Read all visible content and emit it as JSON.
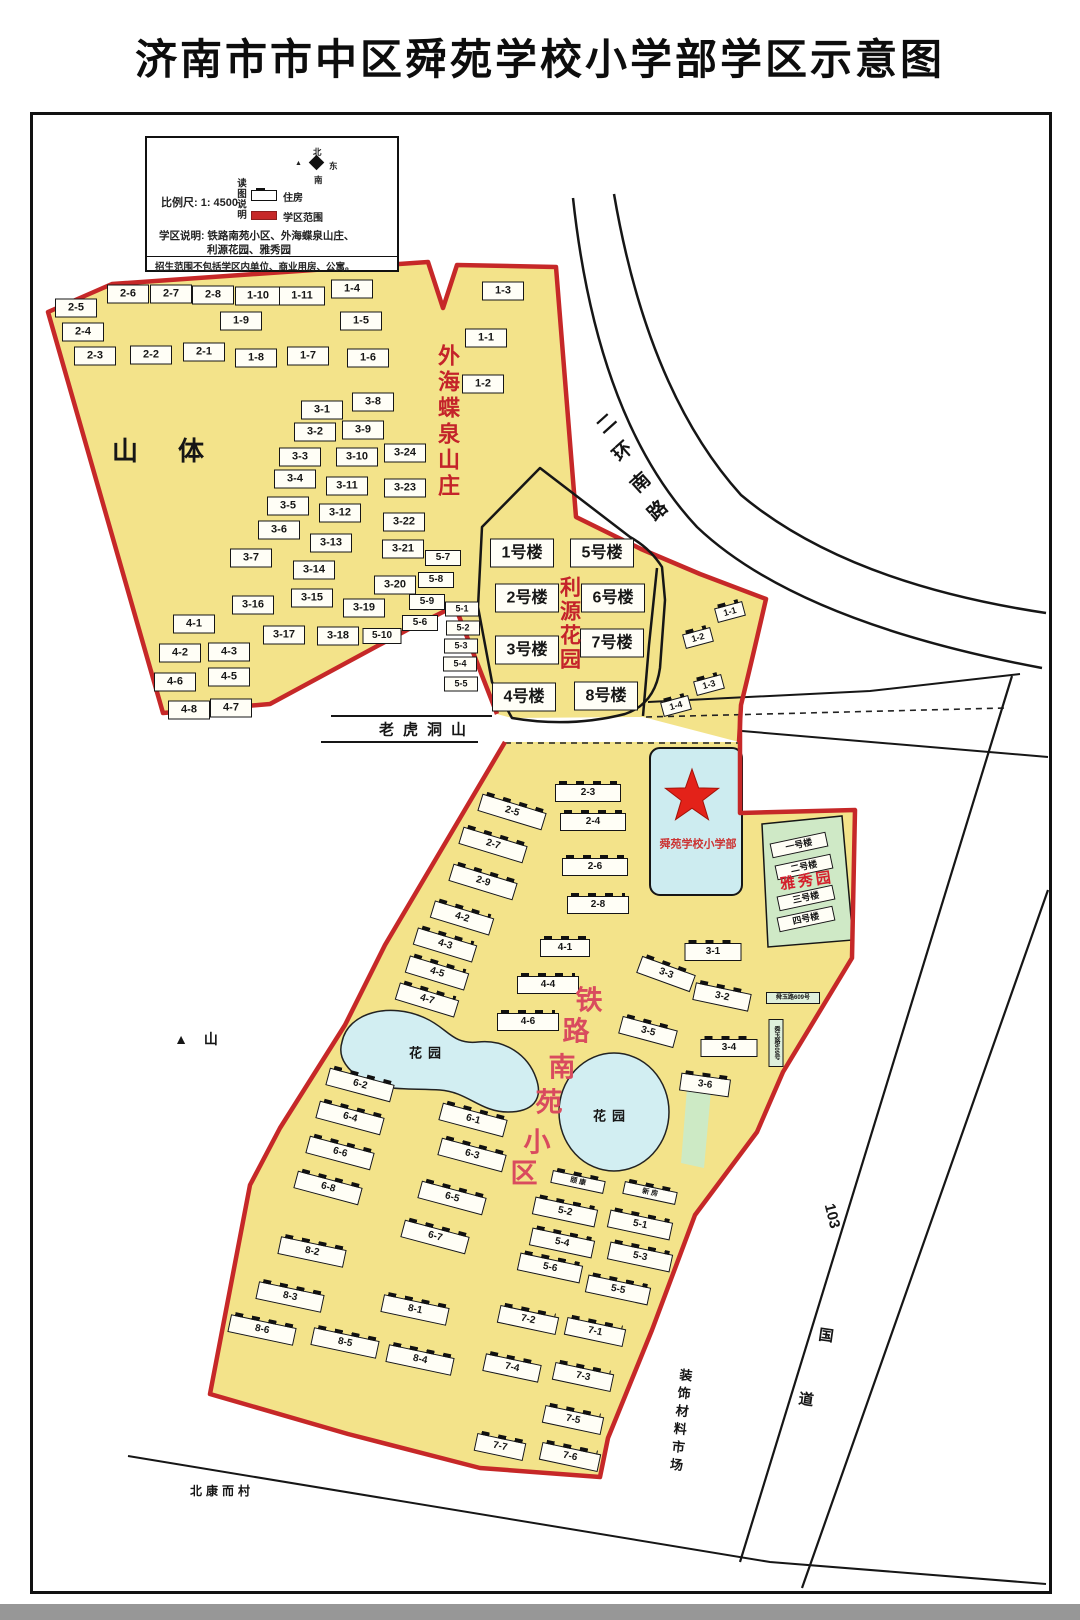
{
  "title": "济南市市中区舜苑学校小学部学区示意图",
  "legend": {
    "scale_label": "比例尺: 1: 4500",
    "reading_note": "读图说明",
    "housing_label": "住房",
    "district_range_label": "学区范围",
    "compass": {
      "north": "北",
      "east": "东",
      "south": "南"
    },
    "district_desc_line1": "学区说明: 铁路南苑小区、外海蝶泉山庄、",
    "district_desc_line2": "利源花园、雅秀园",
    "note": "招生范围不包括学区内单位、商业用房、公寓。"
  },
  "colors": {
    "district_yellow": "#f3e38a",
    "boundary_red": "#c62828",
    "liyuan_outline_black": "#161616",
    "school_cyan": "#cdecf0",
    "pond_cyan": "#d2eef2",
    "green_area": "#cfe9c6",
    "star_red": "#e32219",
    "red_text": "#c4232a",
    "pink_text": "#d94b5e"
  },
  "map": {
    "labels": [
      {
        "t": "山体",
        "x": 178,
        "y": 451,
        "f": 26,
        "ls": 40
      },
      {
        "t": "▲  山",
        "x": 199,
        "y": 1039,
        "f": 14,
        "ls": 6
      },
      {
        "t": "老虎洞山",
        "x": 427,
        "y": 730,
        "f": 15,
        "ls": 9
      },
      {
        "t": "花园",
        "x": 428,
        "y": 1053,
        "f": 13,
        "ls": 6
      },
      {
        "t": "花园",
        "x": 612,
        "y": 1116,
        "f": 13,
        "ls": 6
      },
      {
        "t": "外海蝶泉山庄",
        "x": 447,
        "y": 422,
        "f": 22,
        "c": "#c4232a",
        "vert": true,
        "ls": 4
      },
      {
        "t": "利源花园",
        "x": 569,
        "y": 624,
        "f": 21,
        "c": "#c4232a",
        "vert": true,
        "ls": 3
      },
      {
        "t": "雅秀园",
        "x": 807,
        "y": 881,
        "f": 15,
        "c": "#d41f2c",
        "r": -8,
        "ls": 3
      },
      {
        "t": "舜苑学校小学部",
        "x": 698,
        "y": 845,
        "f": 11,
        "c": "#cc3333"
      },
      {
        "t": "装饰材料市场",
        "x": 680,
        "y": 1422,
        "f": 13,
        "vert": true,
        "ls": 5,
        "r": 6
      },
      {
        "t": "103",
        "x": 832,
        "y": 1216,
        "f": 15,
        "r": 76
      },
      {
        "t": "国",
        "x": 826,
        "y": 1336,
        "f": 15,
        "r": 8
      },
      {
        "t": "道",
        "x": 806,
        "y": 1400,
        "f": 15,
        "r": 8
      },
      {
        "t": "北康而村",
        "x": 222,
        "y": 1491,
        "f": 12,
        "ls": 4
      }
    ],
    "char_labels": [
      {
        "id": "tielu-nanyuan-xiaoqu",
        "c": "#d94b5e",
        "f": 27,
        "r": 0,
        "chars": [
          {
            "t": "铁",
            "x": 589,
            "y": 1001
          },
          {
            "t": "路",
            "x": 576,
            "y": 1032
          },
          {
            "t": "南",
            "x": 562,
            "y": 1068
          },
          {
            "t": "苑",
            "x": 549,
            "y": 1103
          },
          {
            "t": "小",
            "x": 537,
            "y": 1143
          },
          {
            "t": "区",
            "x": 524,
            "y": 1174
          }
        ]
      },
      {
        "id": "erhuan-nanlu",
        "c": "#141414",
        "f": 19,
        "r": -42,
        "chars": [
          {
            "t": "二",
            "x": 607,
            "y": 424
          },
          {
            "t": "环",
            "x": 623,
            "y": 452
          },
          {
            "t": "南",
            "x": 641,
            "y": 483
          },
          {
            "t": "路",
            "x": 658,
            "y": 511
          }
        ]
      }
    ],
    "buildings_plain": [
      {
        "t": "2-6",
        "x": 128,
        "y": 294
      },
      {
        "t": "2-7",
        "x": 171,
        "y": 294
      },
      {
        "t": "2-8",
        "x": 213,
        "y": 295
      },
      {
        "t": "1-10",
        "x": 258,
        "y": 296,
        "w": 44
      },
      {
        "t": "1-11",
        "x": 302,
        "y": 296,
        "w": 44
      },
      {
        "t": "1-4",
        "x": 352,
        "y": 289
      },
      {
        "t": "1-3",
        "x": 503,
        "y": 291
      },
      {
        "t": "2-5",
        "x": 76,
        "y": 308
      },
      {
        "t": "1-9",
        "x": 241,
        "y": 321
      },
      {
        "t": "1-5",
        "x": 361,
        "y": 321
      },
      {
        "t": "2-4",
        "x": 83,
        "y": 332
      },
      {
        "t": "1-6",
        "x": 368,
        "y": 358
      },
      {
        "t": "2-3",
        "x": 95,
        "y": 356
      },
      {
        "t": "2-2",
        "x": 151,
        "y": 355
      },
      {
        "t": "2-1",
        "x": 204,
        "y": 352
      },
      {
        "t": "1-8",
        "x": 256,
        "y": 358
      },
      {
        "t": "1-7",
        "x": 308,
        "y": 356
      },
      {
        "t": "1-1",
        "x": 486,
        "y": 338
      },
      {
        "t": "1-2",
        "x": 483,
        "y": 384
      },
      {
        "t": "3-1",
        "x": 322,
        "y": 410
      },
      {
        "t": "3-8",
        "x": 373,
        "y": 402
      },
      {
        "t": "3-2",
        "x": 315,
        "y": 432
      },
      {
        "t": "3-9",
        "x": 363,
        "y": 430
      },
      {
        "t": "3-3",
        "x": 300,
        "y": 457
      },
      {
        "t": "3-10",
        "x": 357,
        "y": 457
      },
      {
        "t": "3-24",
        "x": 405,
        "y": 453
      },
      {
        "t": "3-4",
        "x": 295,
        "y": 479
      },
      {
        "t": "3-11",
        "x": 347,
        "y": 486
      },
      {
        "t": "3-23",
        "x": 405,
        "y": 488
      },
      {
        "t": "3-5",
        "x": 288,
        "y": 506
      },
      {
        "t": "3-12",
        "x": 340,
        "y": 513
      },
      {
        "t": "3-22",
        "x": 404,
        "y": 522
      },
      {
        "t": "3-6",
        "x": 279,
        "y": 530
      },
      {
        "t": "3-13",
        "x": 331,
        "y": 543
      },
      {
        "t": "3-21",
        "x": 403,
        "y": 549
      },
      {
        "t": "5-7",
        "x": 443,
        "y": 558,
        "w": 34,
        "h": 14,
        "f": 10
      },
      {
        "t": "3-7",
        "x": 251,
        "y": 558
      },
      {
        "t": "3-14",
        "x": 314,
        "y": 570
      },
      {
        "t": "3-20",
        "x": 395,
        "y": 585
      },
      {
        "t": "5-8",
        "x": 436,
        "y": 580,
        "w": 34,
        "h": 14,
        "f": 10
      },
      {
        "t": "3-16",
        "x": 253,
        "y": 605
      },
      {
        "t": "3-15",
        "x": 312,
        "y": 598
      },
      {
        "t": "3-19",
        "x": 364,
        "y": 608
      },
      {
        "t": "5-9",
        "x": 427,
        "y": 602,
        "w": 34,
        "h": 14,
        "f": 10
      },
      {
        "t": "4-1",
        "x": 194,
        "y": 624
      },
      {
        "t": "3-17",
        "x": 284,
        "y": 635
      },
      {
        "t": "3-18",
        "x": 338,
        "y": 636
      },
      {
        "t": "5-10",
        "x": 382,
        "y": 636,
        "w": 37,
        "h": 14,
        "f": 10
      },
      {
        "t": "5-6",
        "x": 420,
        "y": 623,
        "w": 34,
        "h": 14,
        "f": 10
      },
      {
        "t": "5-1",
        "x": 462,
        "y": 609,
        "w": 32,
        "h": 13,
        "f": 9
      },
      {
        "t": "5-2",
        "x": 463,
        "y": 628,
        "w": 32,
        "h": 13,
        "f": 9
      },
      {
        "t": "5-3",
        "x": 461,
        "y": 646,
        "w": 32,
        "h": 13,
        "f": 9
      },
      {
        "t": "5-4",
        "x": 460,
        "y": 664,
        "w": 32,
        "h": 13,
        "f": 9
      },
      {
        "t": "5-5",
        "x": 461,
        "y": 684,
        "w": 32,
        "h": 13,
        "f": 9
      },
      {
        "t": "4-2",
        "x": 180,
        "y": 653
      },
      {
        "t": "4-3",
        "x": 229,
        "y": 652
      },
      {
        "t": "4-6",
        "x": 175,
        "y": 682
      },
      {
        "t": "4-5",
        "x": 229,
        "y": 677
      },
      {
        "t": "4-8",
        "x": 189,
        "y": 710
      },
      {
        "t": "4-7",
        "x": 231,
        "y": 708
      }
    ],
    "buildings_floor": [
      {
        "t": "1号楼",
        "x": 522,
        "y": 553
      },
      {
        "t": "5号楼",
        "x": 602,
        "y": 553
      },
      {
        "t": "2号楼",
        "x": 527,
        "y": 598
      },
      {
        "t": "6号楼",
        "x": 613,
        "y": 598
      },
      {
        "t": "3号楼",
        "x": 527,
        "y": 650
      },
      {
        "t": "7号楼",
        "x": 612,
        "y": 643
      },
      {
        "t": "4号楼",
        "x": 524,
        "y": 697
      },
      {
        "t": "8号楼",
        "x": 606,
        "y": 696
      }
    ],
    "buildings_strip": [
      {
        "t": "1-1",
        "x": 730,
        "y": 612
      },
      {
        "t": "1-2",
        "x": 698,
        "y": 638
      },
      {
        "t": "1-3",
        "x": 709,
        "y": 685
      },
      {
        "t": "1-4",
        "x": 676,
        "y": 706
      }
    ],
    "buildings_yaxiu": [
      {
        "t": "一号楼",
        "x": 799,
        "y": 845
      },
      {
        "t": "二号楼",
        "x": 804,
        "y": 867
      },
      {
        "t": "三号楼",
        "x": 806,
        "y": 898
      },
      {
        "t": "四号楼",
        "x": 806,
        "y": 919
      }
    ],
    "buildings_ticked": [
      {
        "t": "2-5",
        "x": 512,
        "y": 812,
        "w": 65,
        "r": 17
      },
      {
        "t": "2-3",
        "x": 588,
        "y": 793,
        "w": 64
      },
      {
        "t": "2-4",
        "x": 593,
        "y": 822,
        "w": 64
      },
      {
        "t": "2-7",
        "x": 493,
        "y": 845,
        "w": 65,
        "r": 17
      },
      {
        "t": "2-9",
        "x": 483,
        "y": 882,
        "w": 65,
        "r": 17
      },
      {
        "t": "2-6",
        "x": 595,
        "y": 867,
        "w": 64
      },
      {
        "t": "2-8",
        "x": 598,
        "y": 905,
        "w": 60
      },
      {
        "t": "4-2",
        "x": 462,
        "y": 918,
        "w": 60,
        "r": 17
      },
      {
        "t": "4-3",
        "x": 445,
        "y": 945,
        "w": 60,
        "r": 17
      },
      {
        "t": "4-1",
        "x": 565,
        "y": 948,
        "w": 48
      },
      {
        "t": "4-5",
        "x": 437,
        "y": 973,
        "w": 60,
        "r": 17
      },
      {
        "t": "4-4",
        "x": 548,
        "y": 985,
        "w": 60
      },
      {
        "t": "4-7",
        "x": 427,
        "y": 1000,
        "w": 60,
        "r": 17
      },
      {
        "t": "4-6",
        "x": 528,
        "y": 1022,
        "w": 60
      },
      {
        "t": "3-1",
        "x": 713,
        "y": 952,
        "w": 55
      },
      {
        "t": "3-3",
        "x": 666,
        "y": 974,
        "w": 55,
        "r": 20
      },
      {
        "t": "3-2",
        "x": 722,
        "y": 997,
        "w": 55,
        "r": 12
      },
      {
        "t": "3-5",
        "x": 648,
        "y": 1032,
        "w": 55,
        "r": 15
      },
      {
        "t": "3-4",
        "x": 729,
        "y": 1048,
        "w": 55
      },
      {
        "t": "3-6",
        "x": 705,
        "y": 1085,
        "w": 48,
        "r": 8
      },
      {
        "t": "6-2",
        "x": 360,
        "y": 1085,
        "w": 65,
        "r": 15
      },
      {
        "t": "6-4",
        "x": 350,
        "y": 1118,
        "w": 65,
        "r": 15
      },
      {
        "t": "6-1",
        "x": 473,
        "y": 1120,
        "w": 65,
        "r": 15
      },
      {
        "t": "6-6",
        "x": 340,
        "y": 1153,
        "w": 65,
        "r": 15
      },
      {
        "t": "6-3",
        "x": 472,
        "y": 1155,
        "w": 65,
        "r": 15
      },
      {
        "t": "6-8",
        "x": 328,
        "y": 1188,
        "w": 65,
        "r": 15
      },
      {
        "t": "6-5",
        "x": 452,
        "y": 1198,
        "w": 65,
        "r": 15
      },
      {
        "t": "6-7",
        "x": 435,
        "y": 1237,
        "w": 65,
        "r": 15
      },
      {
        "t": "颐 康",
        "x": 578,
        "y": 1182,
        "w": 52,
        "h": 11,
        "f": 7,
        "r": 12
      },
      {
        "t": "新 房",
        "x": 650,
        "y": 1193,
        "w": 52,
        "h": 11,
        "f": 7,
        "r": 12
      },
      {
        "t": "5-2",
        "x": 565,
        "y": 1212,
        "w": 62,
        "r": 12
      },
      {
        "t": "5-1",
        "x": 640,
        "y": 1225,
        "w": 62,
        "r": 12
      },
      {
        "t": "5-4",
        "x": 562,
        "y": 1243,
        "w": 62,
        "r": 12
      },
      {
        "t": "5-3",
        "x": 640,
        "y": 1257,
        "w": 62,
        "r": 12
      },
      {
        "t": "5-6",
        "x": 550,
        "y": 1268,
        "w": 62,
        "r": 12
      },
      {
        "t": "5-5",
        "x": 618,
        "y": 1290,
        "w": 62,
        "r": 12
      },
      {
        "t": "8-2",
        "x": 312,
        "y": 1252,
        "w": 65,
        "r": 12
      },
      {
        "t": "8-3",
        "x": 290,
        "y": 1297,
        "w": 65,
        "r": 12
      },
      {
        "t": "8-1",
        "x": 415,
        "y": 1310,
        "w": 65,
        "r": 12
      },
      {
        "t": "8-6",
        "x": 262,
        "y": 1330,
        "w": 65,
        "r": 12
      },
      {
        "t": "8-5",
        "x": 345,
        "y": 1343,
        "w": 65,
        "r": 12
      },
      {
        "t": "8-4",
        "x": 420,
        "y": 1360,
        "w": 65,
        "r": 12
      },
      {
        "t": "7-2",
        "x": 528,
        "y": 1320,
        "w": 58,
        "r": 12
      },
      {
        "t": "7-1",
        "x": 595,
        "y": 1332,
        "w": 58,
        "r": 12
      },
      {
        "t": "7-4",
        "x": 512,
        "y": 1368,
        "w": 55,
        "r": 12
      },
      {
        "t": "7-3",
        "x": 583,
        "y": 1377,
        "w": 58,
        "r": 12
      },
      {
        "t": "7-5",
        "x": 573,
        "y": 1420,
        "w": 58,
        "r": 12
      },
      {
        "t": "7-7",
        "x": 500,
        "y": 1447,
        "w": 48,
        "r": 12
      },
      {
        "t": "7-6",
        "x": 570,
        "y": 1457,
        "w": 58,
        "r": 12
      }
    ],
    "buildings_green": [
      {
        "t": "舜玉路609号",
        "x": 793,
        "y": 998,
        "w": 52,
        "h": 10,
        "f": 6
      },
      {
        "t": "舜玉路609号",
        "x": 776,
        "y": 1043,
        "w": 13,
        "h": 46,
        "f": 6,
        "vert": true
      }
    ]
  }
}
